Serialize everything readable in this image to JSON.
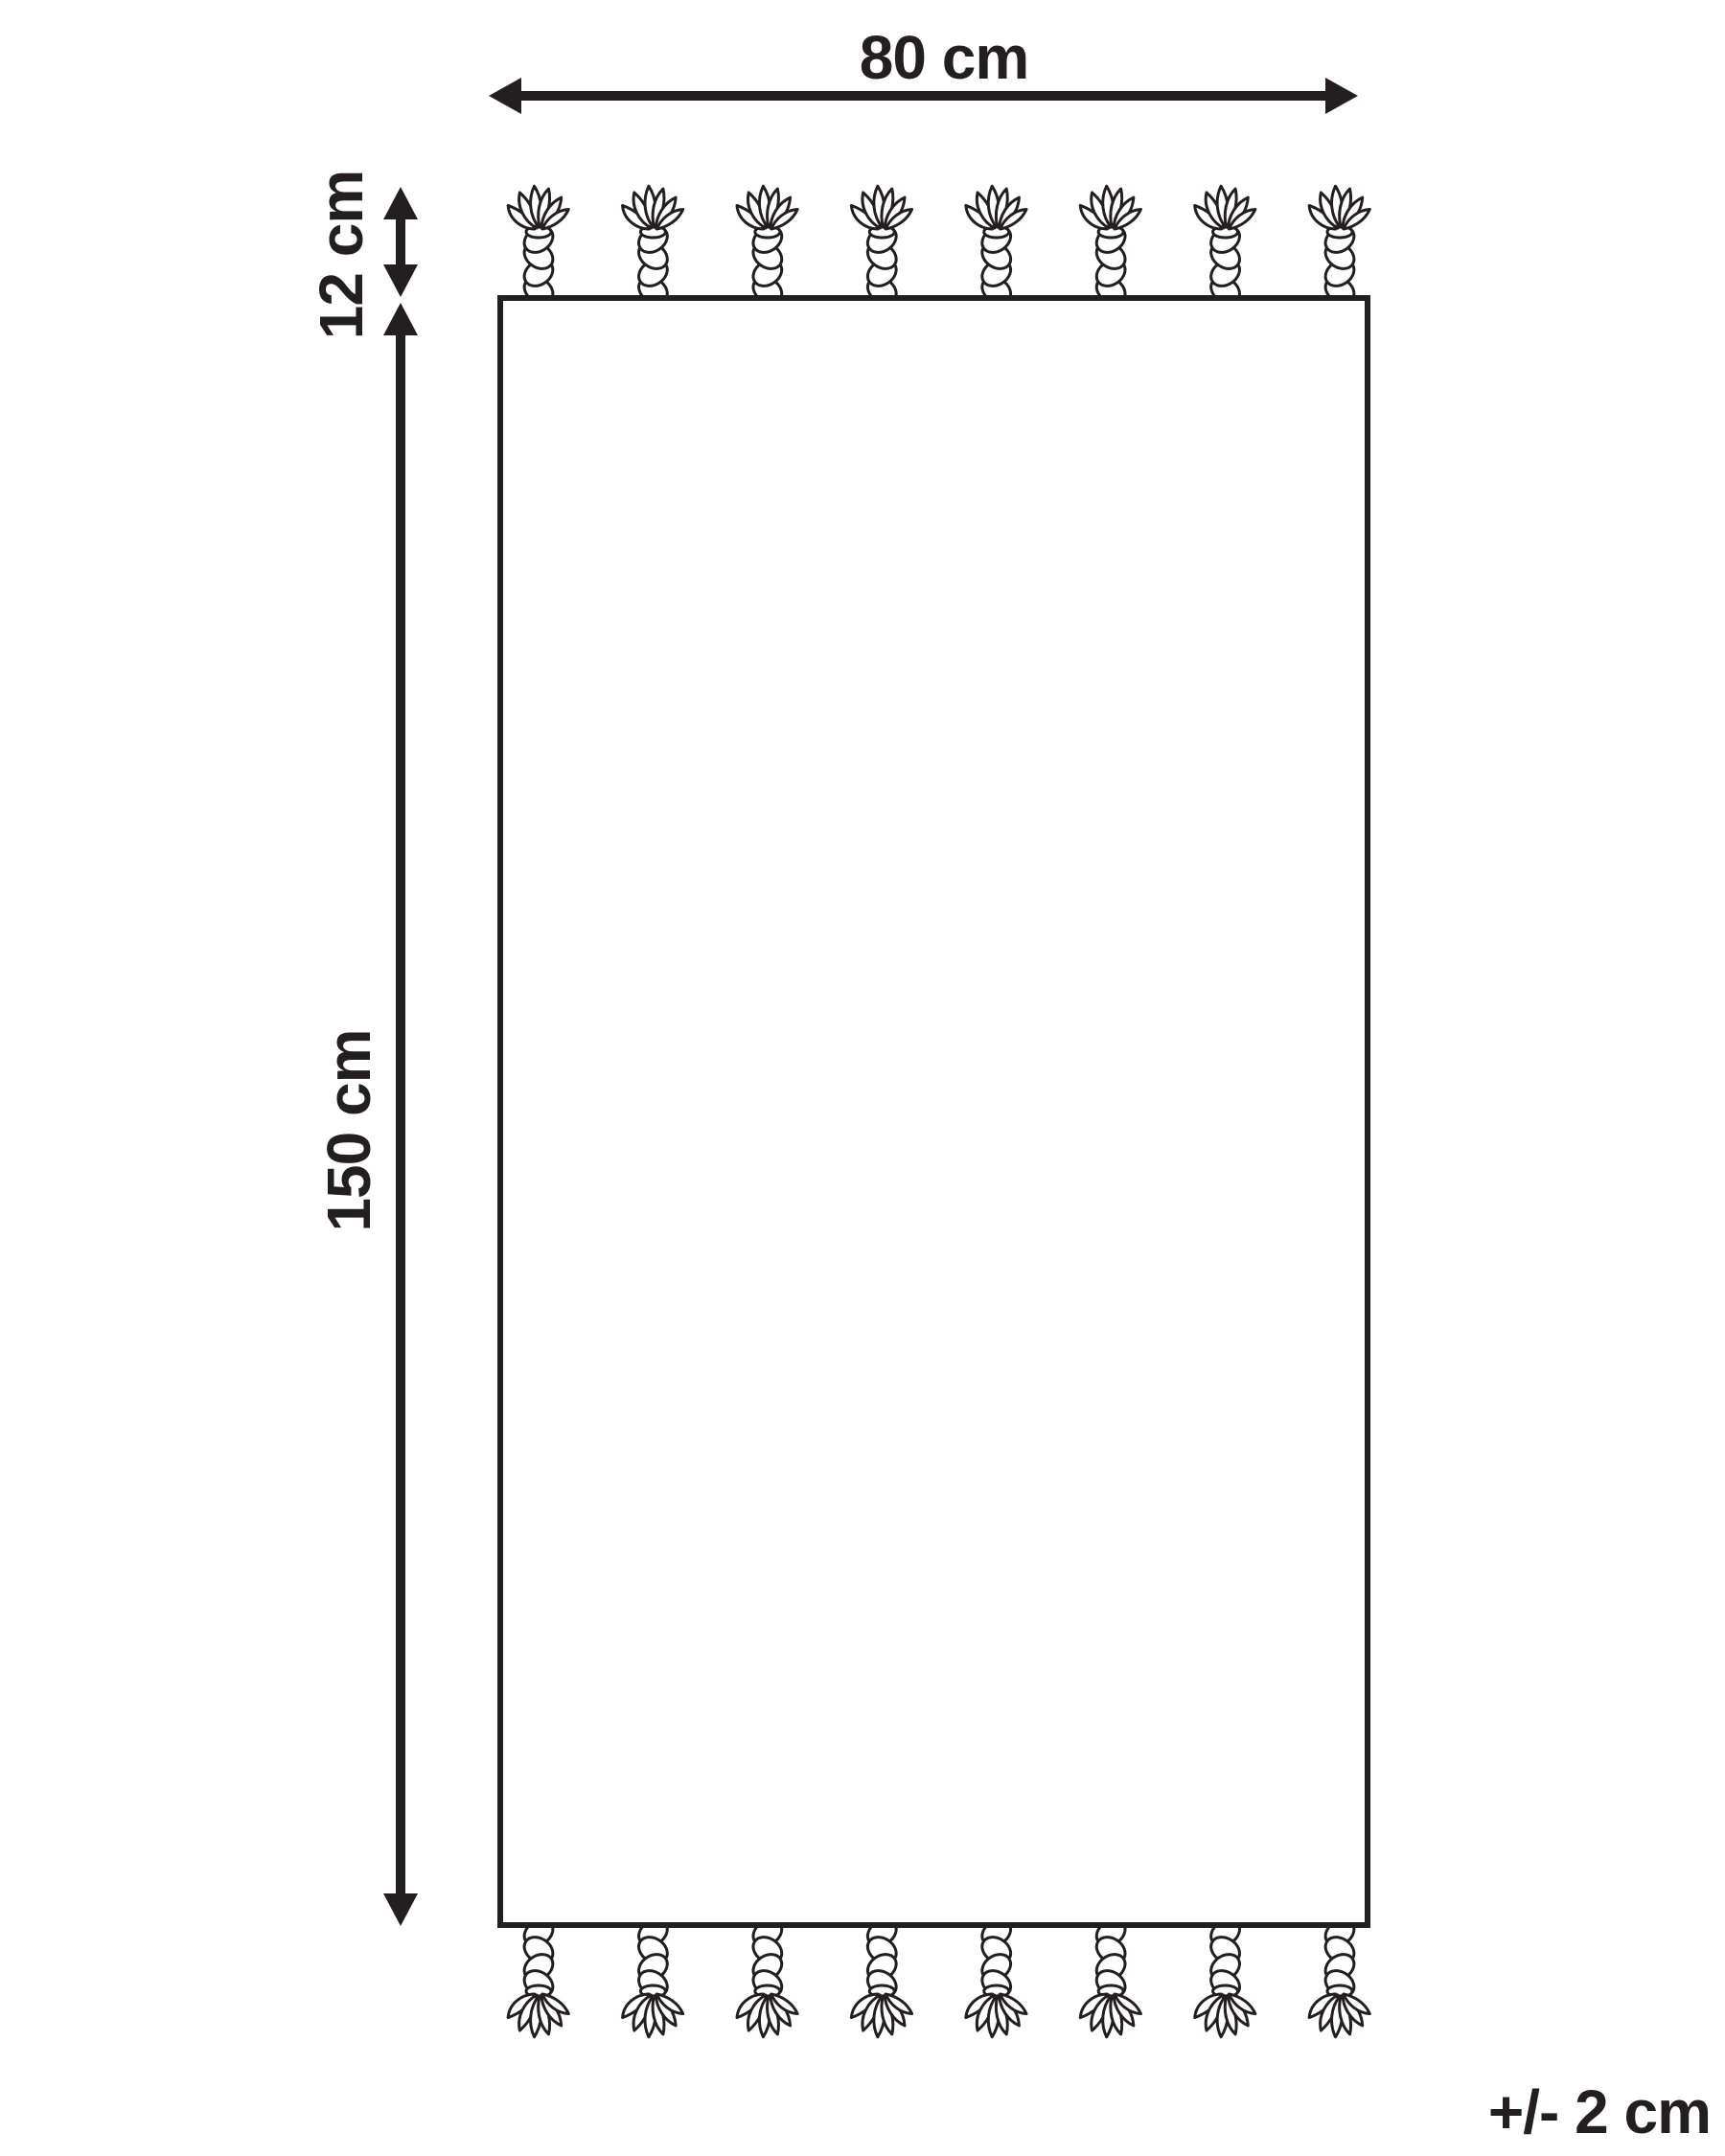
{
  "diagram": {
    "type": "product-dimension-diagram",
    "subject": "rectangular rug / towel with twisted tassel fringe on top and bottom edges",
    "labels": {
      "width": "80 cm",
      "fringe": "12 cm",
      "length": "150 cm",
      "tolerance": "+/- 2 cm"
    },
    "values_cm": {
      "width": 80,
      "fringe_length": 12,
      "body_length": 150,
      "tolerance_plus_minus": 2
    },
    "tassels_per_side": 8,
    "colors": {
      "ink": "#231f20",
      "background": "#ffffff",
      "product_fill": "#ffffff"
    }
  }
}
